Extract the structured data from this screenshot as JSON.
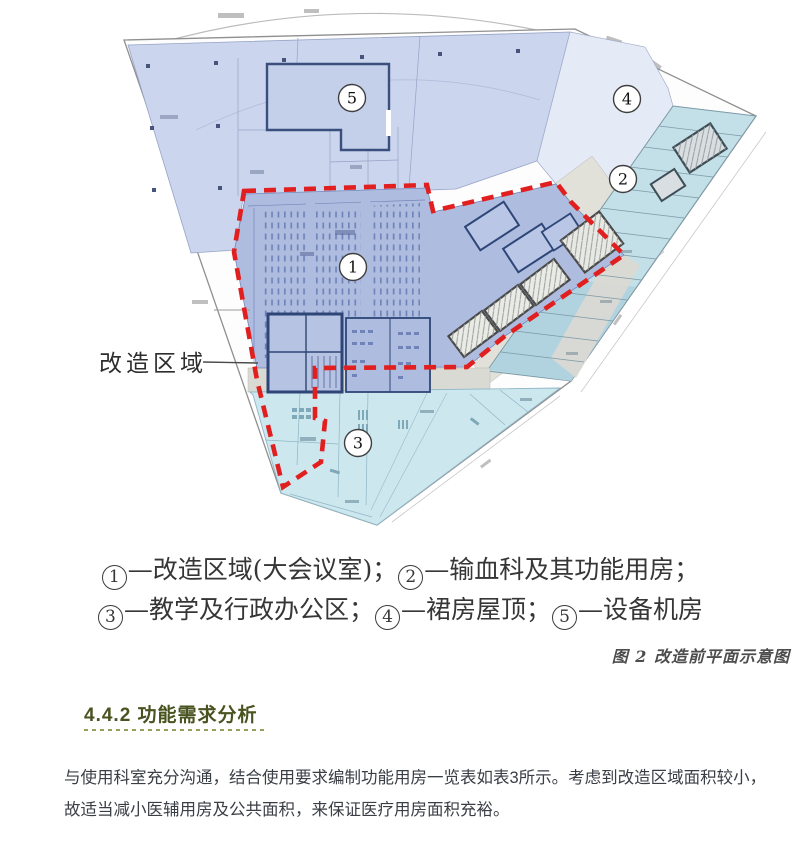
{
  "figure": {
    "renovation_label": "改造区域",
    "circles": {
      "c1": "1",
      "c2": "2",
      "c3": "3",
      "c4": "4",
      "c5": "5"
    },
    "fig_caption": "图 2 改造前平面示意图"
  },
  "legend": {
    "l1_c1": "1",
    "l1_t1": "—改造区域(大会议室)；",
    "l1_c2": "2",
    "l1_t2": "—输血科及其功能用房；",
    "l2_c1": "3",
    "l2_t1": "—教学及行政办公区；",
    "l2_c2": "4",
    "l2_t2": "—裙房屋顶；",
    "l2_c3": "5",
    "l2_t3": "—设备机房"
  },
  "section": {
    "heading": "4.4.2 功能需求分析"
  },
  "body": {
    "line1": "与使用科室充分沟通，结合使用要求编制功能用房一览表如表3所示。考虑到改造区域面积较小，",
    "line2": "故适当减小医辅用房及公共面积，来保证医疗用房面积充裕。"
  },
  "colors": {
    "renovation_boundary_red": "#e11f1f",
    "heading_green": "#49531f",
    "underline_olive": "#97a15c",
    "periwinkle_area": "#cbd5ed",
    "auditorium_blue": "#aebddf",
    "wing_cyan": "#c3dfe8",
    "lower_cyan": "#cde7ef",
    "roof_light": "#e5ebf6",
    "corridor_gray": "#dadad4"
  }
}
